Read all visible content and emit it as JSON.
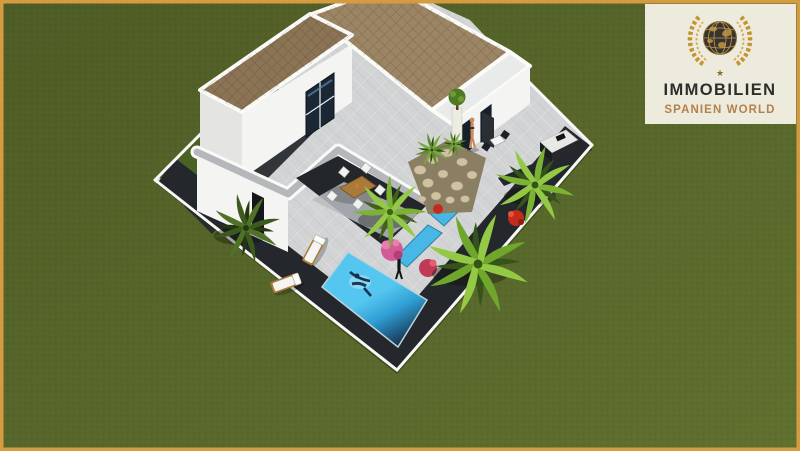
{
  "logo": {
    "line1": "IMMOBILIEN",
    "line2": "SPANIEN WORLD",
    "star": "★"
  },
  "colors": {
    "frame": "#d49b40",
    "grass-dark": "#4e5c25",
    "grass-light": "#60702f",
    "terrace": "#d2d3d5",
    "wall-white": "#f4f4f2",
    "wall-shadow": "#e4e5e3",
    "coping": "#b4b8bb",
    "roof": "#8b7355",
    "roof-light": "#9c8565",
    "dark-path": "#24282c",
    "lawn": "#4a6124",
    "pool-light": "#55c6ef",
    "pool-mid": "#2f9ed4",
    "pool-deep": "#12203a",
    "channel": "#47b8e5",
    "palm-bright": "#7cb335",
    "palm-mid": "#93c944",
    "palm-deep": "#35541a",
    "stone": "#cfc2a2",
    "soil": "#8a7f62",
    "flower-pink": "#d45a95",
    "flower-red": "#c52b1c",
    "skin": "#c98a5c",
    "wood": "#a97a3a",
    "logo-bg": "#edebde",
    "logo-text": "#2e2d2b",
    "logo-accent": "#b5814a",
    "logo-gold": "#c4922f",
    "globe": "#35342e"
  }
}
